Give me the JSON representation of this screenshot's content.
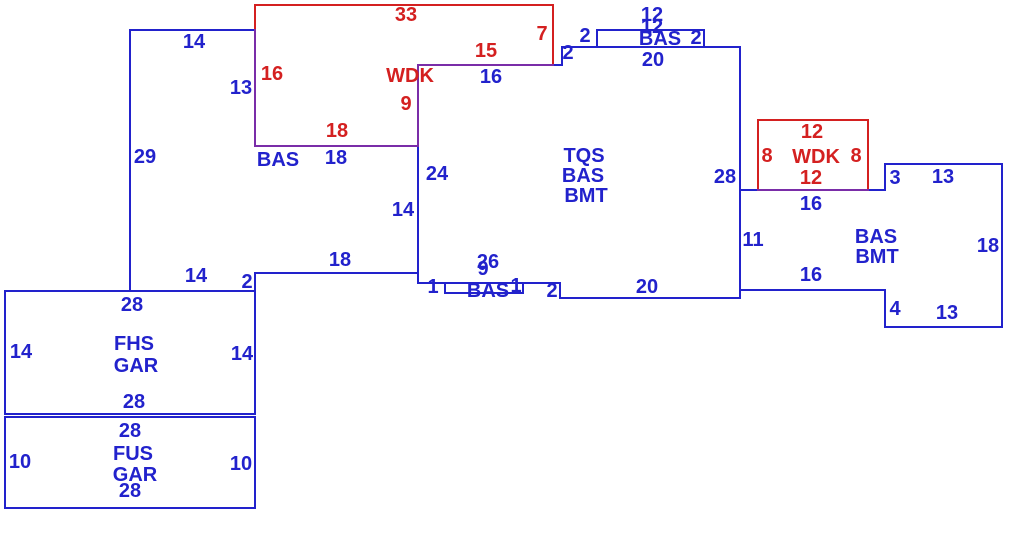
{
  "sketch": {
    "description": "Appraisal floor-plan sketch with dimensioned building footprints",
    "canvas": {
      "width": 1030,
      "height": 552,
      "background": "#ffffff"
    },
    "colors": {
      "blue": "#2222cc",
      "red": "#d42020",
      "purple": "#7a2da8"
    },
    "area_codes_visible": [
      "BAS",
      "WDK",
      "TQS",
      "BMT",
      "FHS",
      "GAR",
      "FUS"
    ],
    "segments": [
      {
        "name": "left-bas-top",
        "x1": 130,
        "y1": 30,
        "x2": 255,
        "y2": 30,
        "color": "blue"
      },
      {
        "name": "left-bas-left",
        "x1": 130,
        "y1": 30,
        "x2": 130,
        "y2": 291,
        "color": "blue"
      },
      {
        "name": "fhs-gar-top",
        "x1": 5,
        "y1": 291,
        "x2": 255,
        "y2": 291,
        "color": "blue"
      },
      {
        "name": "left-bas-step",
        "x1": 255,
        "y1": 273,
        "x2": 255,
        "y2": 291,
        "color": "blue"
      },
      {
        "name": "left-bas-bottom",
        "x1": 255,
        "y1": 273,
        "x2": 418,
        "y2": 273,
        "color": "blue"
      },
      {
        "name": "main-left",
        "x1": 418,
        "y1": 65,
        "x2": 418,
        "y2": 283,
        "color": "blue"
      },
      {
        "name": "main-top-left",
        "x1": 418,
        "y1": 65,
        "x2": 562,
        "y2": 65,
        "color": "blue"
      },
      {
        "name": "main-top-step",
        "x1": 562,
        "y1": 47,
        "x2": 562,
        "y2": 65,
        "color": "blue"
      },
      {
        "name": "main-top",
        "x1": 562,
        "y1": 47,
        "x2": 740,
        "y2": 47,
        "color": "blue"
      },
      {
        "name": "top-bumpout-top",
        "x1": 597,
        "y1": 30,
        "x2": 704,
        "y2": 30,
        "color": "blue"
      },
      {
        "name": "top-bumpout-left",
        "x1": 597,
        "y1": 30,
        "x2": 597,
        "y2": 47,
        "color": "blue"
      },
      {
        "name": "top-bumpout-right",
        "x1": 704,
        "y1": 30,
        "x2": 704,
        "y2": 47,
        "color": "blue"
      },
      {
        "name": "main-right",
        "x1": 740,
        "y1": 47,
        "x2": 740,
        "y2": 298,
        "color": "blue"
      },
      {
        "name": "main-bottom-right",
        "x1": 560,
        "y1": 298,
        "x2": 740,
        "y2": 298,
        "color": "blue"
      },
      {
        "name": "main-bottom-step",
        "x1": 560,
        "y1": 283,
        "x2": 560,
        "y2": 298,
        "color": "blue"
      },
      {
        "name": "main-bottom-left",
        "x1": 418,
        "y1": 283,
        "x2": 560,
        "y2": 283,
        "color": "blue"
      },
      {
        "name": "stoop-left",
        "x1": 445,
        "y1": 283,
        "x2": 445,
        "y2": 293,
        "color": "blue"
      },
      {
        "name": "stoop-bottom",
        "x1": 445,
        "y1": 293,
        "x2": 523,
        "y2": 293,
        "color": "blue"
      },
      {
        "name": "stoop-right",
        "x1": 523,
        "y1": 283,
        "x2": 523,
        "y2": 293,
        "color": "blue"
      },
      {
        "name": "right-bas-top-left",
        "x1": 740,
        "y1": 190,
        "x2": 885,
        "y2": 190,
        "color": "blue"
      },
      {
        "name": "right-bas-step-up",
        "x1": 885,
        "y1": 164,
        "x2": 885,
        "y2": 190,
        "color": "blue"
      },
      {
        "name": "right-bas-top",
        "x1": 885,
        "y1": 164,
        "x2": 1002,
        "y2": 164,
        "color": "blue"
      },
      {
        "name": "right-bas-right",
        "x1": 1002,
        "y1": 164,
        "x2": 1002,
        "y2": 327,
        "color": "blue"
      },
      {
        "name": "right-bas-bottom",
        "x1": 885,
        "y1": 327,
        "x2": 1002,
        "y2": 327,
        "color": "blue"
      },
      {
        "name": "right-bas-step-down",
        "x1": 885,
        "y1": 290,
        "x2": 885,
        "y2": 327,
        "color": "blue"
      },
      {
        "name": "right-bas-bottom-left",
        "x1": 740,
        "y1": 290,
        "x2": 885,
        "y2": 290,
        "color": "blue"
      },
      {
        "name": "fhs-gar-left",
        "x1": 5,
        "y1": 291,
        "x2": 5,
        "y2": 414,
        "color": "blue"
      },
      {
        "name": "fhs-gar-bottom",
        "x1": 5,
        "y1": 414,
        "x2": 255,
        "y2": 414,
        "color": "blue"
      },
      {
        "name": "fhs-gar-right",
        "x1": 255,
        "y1": 291,
        "x2": 255,
        "y2": 414,
        "color": "blue"
      },
      {
        "name": "fus-gar-top",
        "x1": 5,
        "y1": 417,
        "x2": 255,
        "y2": 417,
        "color": "blue"
      },
      {
        "name": "fus-gar-left",
        "x1": 5,
        "y1": 417,
        "x2": 5,
        "y2": 508,
        "color": "blue"
      },
      {
        "name": "fus-gar-bottom",
        "x1": 5,
        "y1": 508,
        "x2": 255,
        "y2": 508,
        "color": "blue"
      },
      {
        "name": "fus-gar-right",
        "x1": 255,
        "y1": 417,
        "x2": 255,
        "y2": 508,
        "color": "blue"
      },
      {
        "name": "wdk-top-outline-top",
        "x1": 255,
        "y1": 5,
        "x2": 553,
        "y2": 5,
        "color": "red"
      },
      {
        "name": "wdk-top-outline-right",
        "x1": 553,
        "y1": 5,
        "x2": 553,
        "y2": 65,
        "color": "red"
      },
      {
        "name": "wdk-top-outline-left",
        "x1": 255,
        "y1": 5,
        "x2": 255,
        "y2": 30,
        "color": "red"
      },
      {
        "name": "wdk-right-rect-top",
        "x1": 758,
        "y1": 120,
        "x2": 868,
        "y2": 120,
        "color": "red"
      },
      {
        "name": "wdk-right-rect-left",
        "x1": 758,
        "y1": 120,
        "x2": 758,
        "y2": 190,
        "color": "red"
      },
      {
        "name": "wdk-right-rect-right",
        "x1": 868,
        "y1": 120,
        "x2": 868,
        "y2": 190,
        "color": "red"
      },
      {
        "name": "shared-wdk-bas-left",
        "x1": 255,
        "y1": 30,
        "x2": 255,
        "y2": 146,
        "color": "purple"
      },
      {
        "name": "shared-wdk-bas-bottom",
        "x1": 255,
        "y1": 146,
        "x2": 418,
        "y2": 146,
        "color": "purple"
      },
      {
        "name": "shared-wdk-main-left",
        "x1": 418,
        "y1": 65,
        "x2": 418,
        "y2": 146,
        "color": "purple"
      },
      {
        "name": "shared-wdk-main-top",
        "x1": 418,
        "y1": 65,
        "x2": 553,
        "y2": 65,
        "color": "purple"
      },
      {
        "name": "shared-wdk-right-bottom",
        "x1": 758,
        "y1": 190,
        "x2": 868,
        "y2": 190,
        "color": "purple"
      }
    ],
    "labels": [
      {
        "group": "left-bas",
        "text": "14",
        "x": 194,
        "y": 42,
        "color": "blue"
      },
      {
        "group": "left-bas",
        "text": "13",
        "x": 241,
        "y": 88,
        "color": "blue"
      },
      {
        "group": "left-bas",
        "text": "29",
        "x": 145,
        "y": 157,
        "color": "blue"
      },
      {
        "group": "left-bas",
        "text": "BAS",
        "x": 278,
        "y": 160,
        "color": "blue"
      },
      {
        "group": "left-bas",
        "text": "18",
        "x": 336,
        "y": 158,
        "color": "blue"
      },
      {
        "group": "left-bas",
        "text": "18",
        "x": 340,
        "y": 260,
        "color": "blue"
      },
      {
        "group": "left-bas",
        "text": "14",
        "x": 196,
        "y": 276,
        "color": "blue"
      },
      {
        "group": "left-bas",
        "text": "2",
        "x": 247,
        "y": 282,
        "color": "blue"
      },
      {
        "group": "wdk-upper",
        "text": "33",
        "x": 406,
        "y": 15,
        "color": "red"
      },
      {
        "group": "wdk-upper",
        "text": "7",
        "x": 542,
        "y": 34,
        "color": "red"
      },
      {
        "group": "wdk-upper",
        "text": "15",
        "x": 486,
        "y": 51,
        "color": "red"
      },
      {
        "group": "wdk-upper",
        "text": "WDK",
        "x": 410,
        "y": 76,
        "color": "red"
      },
      {
        "group": "wdk-upper",
        "text": "16",
        "x": 272,
        "y": 74,
        "color": "red"
      },
      {
        "group": "wdk-upper",
        "text": "18",
        "x": 337,
        "y": 131,
        "color": "red"
      },
      {
        "group": "wdk-upper",
        "text": "9",
        "x": 406,
        "y": 104,
        "color": "red"
      },
      {
        "group": "main",
        "text": "16",
        "x": 491,
        "y": 77,
        "color": "blue"
      },
      {
        "group": "main",
        "text": "24",
        "x": 437,
        "y": 174,
        "color": "blue"
      },
      {
        "group": "main",
        "text": "14",
        "x": 403,
        "y": 210,
        "color": "blue"
      },
      {
        "group": "main",
        "text": "TQS",
        "x": 584,
        "y": 156,
        "color": "blue"
      },
      {
        "group": "main",
        "text": "BAS",
        "x": 583,
        "y": 176,
        "color": "blue"
      },
      {
        "group": "main",
        "text": "BMT",
        "x": 586,
        "y": 196,
        "color": "blue"
      },
      {
        "group": "main",
        "text": "28",
        "x": 725,
        "y": 177,
        "color": "blue"
      },
      {
        "group": "main",
        "text": "2",
        "x": 568,
        "y": 53,
        "color": "blue"
      },
      {
        "group": "main",
        "text": "2",
        "x": 585,
        "y": 36,
        "color": "blue"
      },
      {
        "group": "main",
        "text": "2",
        "x": 696,
        "y": 38,
        "color": "blue"
      },
      {
        "group": "main",
        "text": "20",
        "x": 653,
        "y": 60,
        "color": "blue"
      },
      {
        "group": "main",
        "text": "20",
        "x": 647,
        "y": 287,
        "color": "blue"
      },
      {
        "group": "main",
        "text": "2",
        "x": 552,
        "y": 291,
        "color": "blue"
      },
      {
        "group": "top-bumpout",
        "text": "12",
        "x": 652,
        "y": 15,
        "color": "blue"
      },
      {
        "group": "top-bumpout",
        "text": "12",
        "x": 652,
        "y": 27,
        "color": "blue"
      },
      {
        "group": "top-bumpout",
        "text": "BAS",
        "x": 660,
        "y": 39,
        "color": "blue"
      },
      {
        "group": "bottom-stoop",
        "text": "26",
        "x": 488,
        "y": 262,
        "color": "blue"
      },
      {
        "group": "bottom-stoop",
        "text": "9",
        "x": 483,
        "y": 269,
        "color": "blue"
      },
      {
        "group": "bottom-stoop",
        "text": "1",
        "x": 433,
        "y": 287,
        "color": "blue"
      },
      {
        "group": "bottom-stoop",
        "text": "BAS",
        "x": 488,
        "y": 291,
        "color": "blue"
      },
      {
        "group": "bottom-stoop",
        "text": "1",
        "x": 516,
        "y": 286,
        "color": "blue"
      },
      {
        "group": "wdk-right",
        "text": "12",
        "x": 812,
        "y": 132,
        "color": "red"
      },
      {
        "group": "wdk-right",
        "text": "8",
        "x": 767,
        "y": 156,
        "color": "red"
      },
      {
        "group": "wdk-right",
        "text": "WDK",
        "x": 816,
        "y": 157,
        "color": "red"
      },
      {
        "group": "wdk-right",
        "text": "8",
        "x": 856,
        "y": 156,
        "color": "red"
      },
      {
        "group": "wdk-right",
        "text": "12",
        "x": 811,
        "y": 178,
        "color": "red"
      },
      {
        "group": "right-bas-bmt",
        "text": "16",
        "x": 811,
        "y": 204,
        "color": "blue"
      },
      {
        "group": "right-bas-bmt",
        "text": "11",
        "x": 753,
        "y": 240,
        "color": "blue"
      },
      {
        "group": "right-bas-bmt",
        "text": "BAS",
        "x": 876,
        "y": 237,
        "color": "blue"
      },
      {
        "group": "right-bas-bmt",
        "text": "BMT",
        "x": 877,
        "y": 257,
        "color": "blue"
      },
      {
        "group": "right-bas-bmt",
        "text": "3",
        "x": 895,
        "y": 178,
        "color": "blue"
      },
      {
        "group": "right-bas-bmt",
        "text": "13",
        "x": 943,
        "y": 177,
        "color": "blue"
      },
      {
        "group": "right-bas-bmt",
        "text": "18",
        "x": 988,
        "y": 246,
        "color": "blue"
      },
      {
        "group": "right-bas-bmt",
        "text": "16",
        "x": 811,
        "y": 275,
        "color": "blue"
      },
      {
        "group": "right-bas-bmt",
        "text": "4",
        "x": 895,
        "y": 309,
        "color": "blue"
      },
      {
        "group": "right-bas-bmt",
        "text": "13",
        "x": 947,
        "y": 313,
        "color": "blue"
      },
      {
        "group": "fhs-gar",
        "text": "28",
        "x": 132,
        "y": 305,
        "color": "blue"
      },
      {
        "group": "fhs-gar",
        "text": "14",
        "x": 21,
        "y": 352,
        "color": "blue"
      },
      {
        "group": "fhs-gar",
        "text": "FHS",
        "x": 134,
        "y": 344,
        "color": "blue"
      },
      {
        "group": "fhs-gar",
        "text": "GAR",
        "x": 136,
        "y": 366,
        "color": "blue"
      },
      {
        "group": "fhs-gar",
        "text": "14",
        "x": 242,
        "y": 354,
        "color": "blue"
      },
      {
        "group": "fhs-gar",
        "text": "28",
        "x": 134,
        "y": 402,
        "color": "blue"
      },
      {
        "group": "fus-gar",
        "text": "28",
        "x": 130,
        "y": 431,
        "color": "blue"
      },
      {
        "group": "fus-gar",
        "text": "10",
        "x": 20,
        "y": 462,
        "color": "blue"
      },
      {
        "group": "fus-gar",
        "text": "FUS",
        "x": 133,
        "y": 454,
        "color": "blue"
      },
      {
        "group": "fus-gar",
        "text": "GAR",
        "x": 135,
        "y": 475,
        "color": "blue"
      },
      {
        "group": "fus-gar",
        "text": "10",
        "x": 241,
        "y": 464,
        "color": "blue"
      },
      {
        "group": "fus-gar",
        "text": "28",
        "x": 130,
        "y": 491,
        "color": "blue"
      }
    ]
  }
}
